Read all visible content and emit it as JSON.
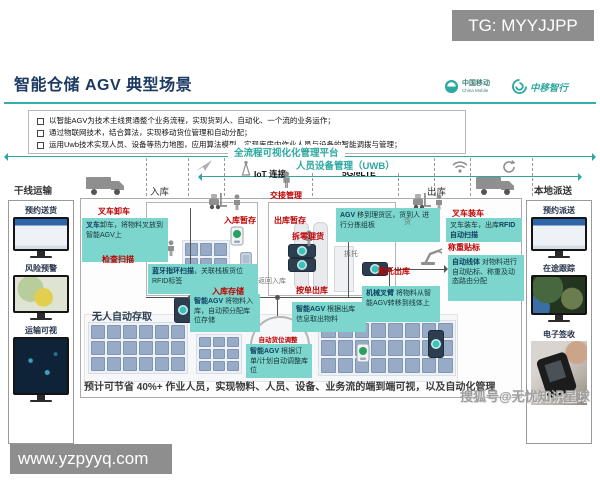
{
  "watermarks": {
    "tg": "TG: MYYJJPP",
    "site": "www.yzpyyq.com",
    "sohu": "搜狐号@无忧知识星球"
  },
  "header": {
    "title": "智能仓储 AGV 典型场景",
    "cmcc": "中国移动",
    "cmcc_sub": "China Mobile",
    "cmzx": "中移智行"
  },
  "bullets": [
    "以智能AGV为技术主线贯通整个业务流程，实现货到人、自动化、一个流的业务运作；",
    "通过物联网技术，结合算法，实现移动货位管理和自动分配；",
    "运用Uwb技术实现人员、设备等热力地图，应用算法模型，实现库房内作业人员与设备的智能调拨与管理；"
  ],
  "bars": {
    "platform": "全流程可视化化管理平台",
    "uwb": "人员设备管理（UWB）",
    "iot": "IoT 连接",
    "g5": "5G/eLTE"
  },
  "zones": {
    "trunk": "干线运输",
    "inbound": "入库",
    "handover": "交接管理",
    "outbound": "出库",
    "local": "本地派送"
  },
  "left_panel": {
    "item1": "预约送货",
    "item2": "风险预警",
    "item3": "运输可视"
  },
  "right_panel": {
    "item1": "预约派送",
    "item2": "在途跟踪",
    "item3": "电子签收"
  },
  "diagram": {
    "labels": {
      "forklift_unload": "叉车卸车",
      "check_scan": "检查扫描",
      "inbound_staging": "入库暂存",
      "outbound_staging": "出库暂存",
      "pick_sort": "拆零理货",
      "full_pallet_out": "整托出库",
      "order_out": "按单出库",
      "return_in": "返回入库",
      "inbound_storage": "入库存储",
      "forklift_load": "叉车装车",
      "weigh_label": "称重贴标",
      "auto_slot": "自动货位调整",
      "unmanned": "无人自动存取",
      "depal": "拆托",
      "cargo": "货"
    },
    "notes": {
      "unload": {
        "lead": "叉车",
        "text": "卸车，将物料叉放到智能AGV上"
      },
      "bluetooth": {
        "lead": "蓝牙指环扫描",
        "text": "，关联栈板货位RFID标签"
      },
      "agv_move": {
        "lead": "AGV",
        "text": "移到理货区，货到人 进行分拣组板"
      },
      "load": {
        "pre": "叉车装车，出库",
        "bold": "RFID自动扫描"
      },
      "auto_line": {
        "lead": "自动线体",
        "text": "对物料进行自动贴标、称重及动态路由分配"
      },
      "arm": {
        "lead": "机械叉臂",
        "text": "将物料从智能AGV转移到线体上"
      },
      "store": {
        "lead": "智能AGV",
        "text": "将物料入库，自动预分配库位存储"
      },
      "fetch": {
        "lead": "智能AGV",
        "text": "根据出库信息取出物料"
      },
      "adjust": {
        "lead": "智能AGV",
        "text": "根据订单/计划自动调整库位"
      }
    },
    "summary": "预计可节省 40%+ 作业人员，实现物料、人员、设备、业务流的端到端可视，以及自动化管理"
  },
  "colors": {
    "teal": "#2da8a1",
    "note_bg": "#7cd6cd",
    "red": "#c00000",
    "navy": "#1d3a63"
  }
}
